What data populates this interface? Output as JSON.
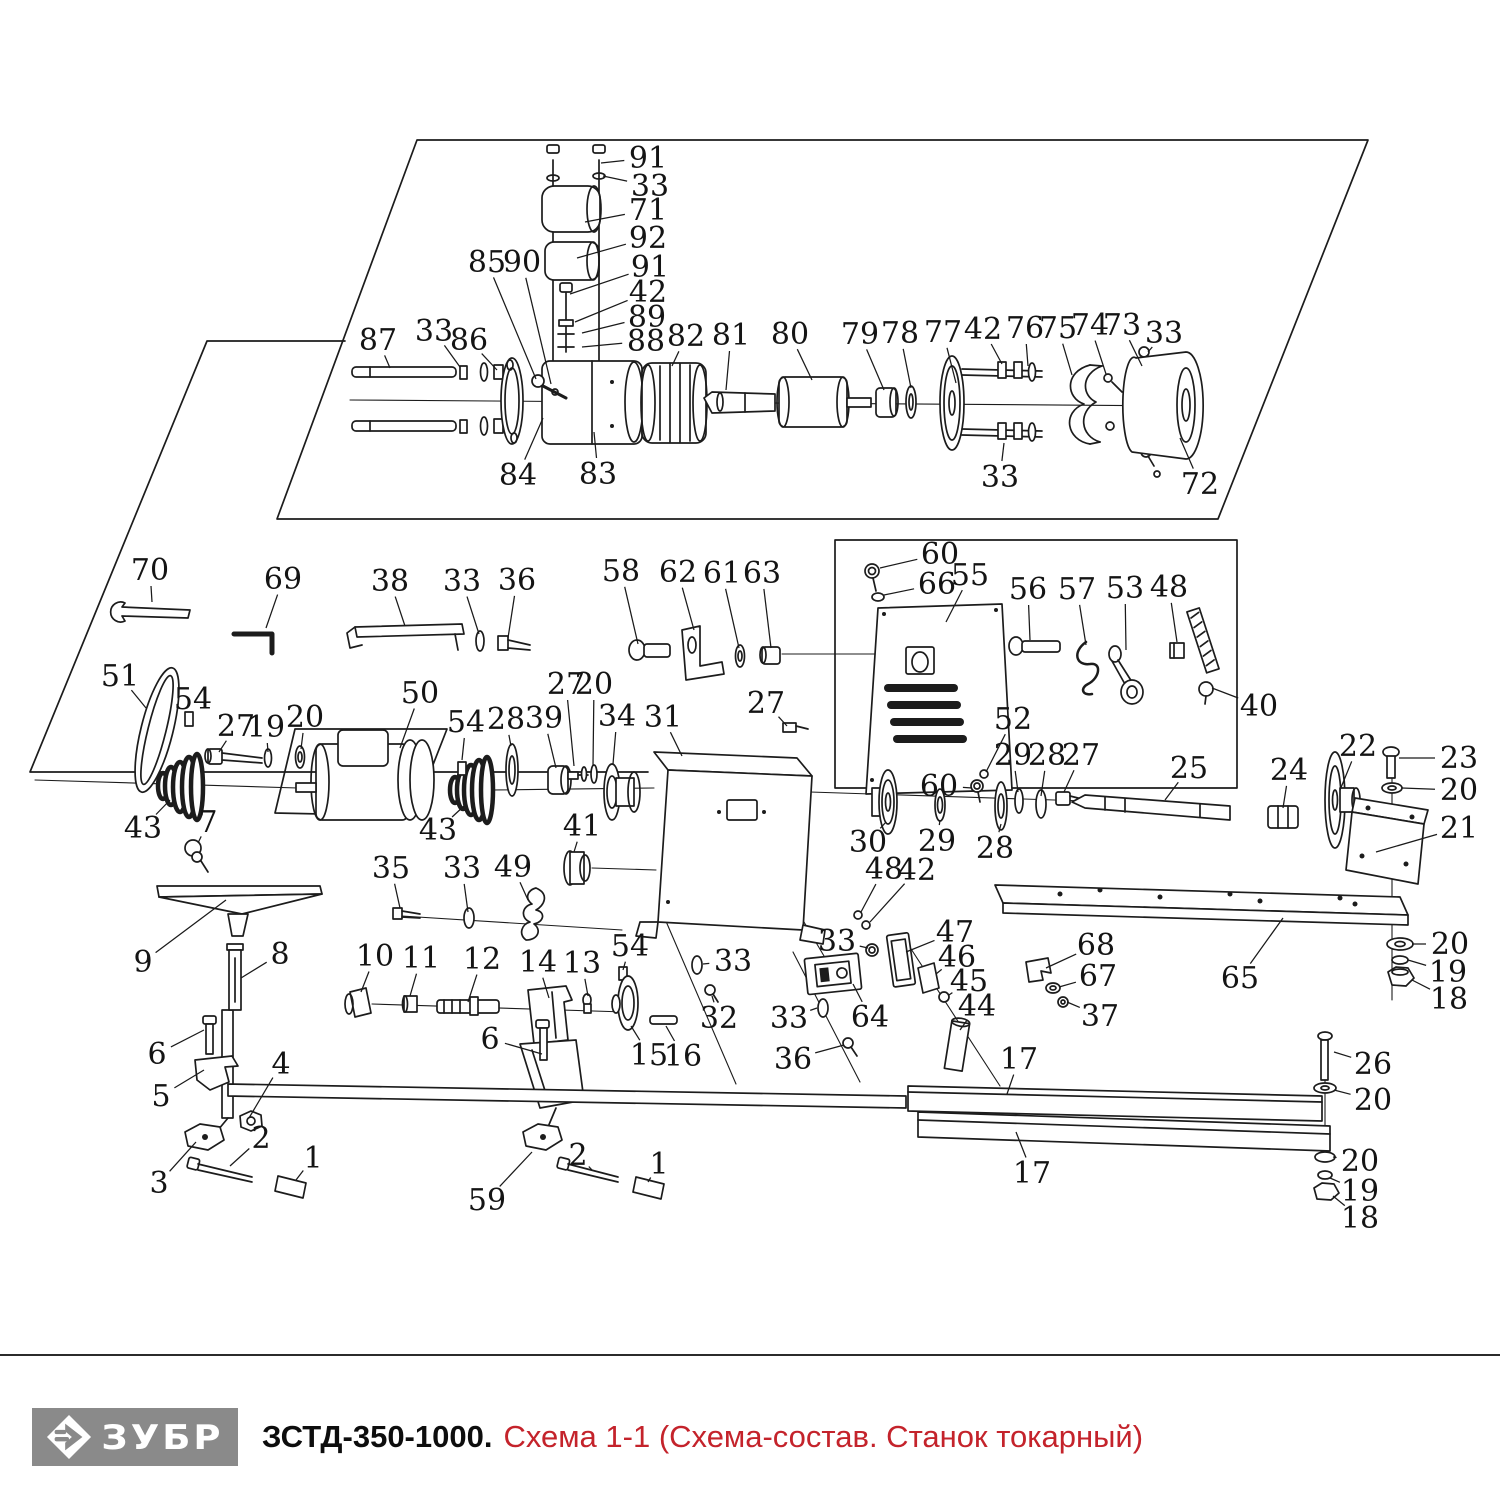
{
  "footer": {
    "brand": "ЗУБР",
    "model": "ЗСТД-350-1000.",
    "subtitle": "Схема 1-1 (Схема-состав. Станок токарный)",
    "logo_bg": "#8a8a8a",
    "accent": "#c4232b",
    "line_color": "#1c1c1c"
  },
  "diagram": {
    "labels": [
      {
        "n": "91",
        "x": 648,
        "y": 158,
        "tx": 601,
        "ty": 163
      },
      {
        "n": "33",
        "x": 650,
        "y": 186,
        "tx": 603,
        "ty": 176
      },
      {
        "n": "71",
        "x": 648,
        "y": 210,
        "tx": 585,
        "ty": 222
      },
      {
        "n": "92",
        "x": 648,
        "y": 238,
        "tx": 577,
        "ty": 258
      },
      {
        "n": "91",
        "x": 650,
        "y": 267,
        "tx": 570,
        "ty": 294
      },
      {
        "n": "42",
        "x": 648,
        "y": 292,
        "tx": 575,
        "ty": 322
      },
      {
        "n": "89",
        "x": 647,
        "y": 317,
        "tx": 582,
        "ty": 333
      },
      {
        "n": "88",
        "x": 646,
        "y": 341,
        "tx": 582,
        "ty": 347
      },
      {
        "n": "85",
        "x": 487,
        "y": 262,
        "tx": 536,
        "ty": 379
      },
      {
        "n": "90",
        "x": 522,
        "y": 262,
        "tx": 551,
        "ty": 384
      },
      {
        "n": "87",
        "x": 378,
        "y": 340,
        "tx": 390,
        "ty": 368
      },
      {
        "n": "33",
        "x": 434,
        "y": 331,
        "tx": 460,
        "ty": 367
      },
      {
        "n": "86",
        "x": 469,
        "y": 340,
        "tx": 497,
        "ty": 370
      },
      {
        "n": "84",
        "x": 518,
        "y": 475,
        "tx": 543,
        "ty": 418
      },
      {
        "n": "83",
        "x": 598,
        "y": 474,
        "tx": 594,
        "ty": 432
      },
      {
        "n": "82",
        "x": 686,
        "y": 336,
        "tx": 672,
        "ty": 366
      },
      {
        "n": "81",
        "x": 731,
        "y": 335,
        "tx": 726,
        "ty": 390
      },
      {
        "n": "80",
        "x": 790,
        "y": 334,
        "tx": 812,
        "ty": 380
      },
      {
        "n": "79",
        "x": 860,
        "y": 334,
        "tx": 884,
        "ty": 390
      },
      {
        "n": "78",
        "x": 900,
        "y": 333,
        "tx": 911,
        "ty": 388
      },
      {
        "n": "77",
        "x": 943,
        "y": 332,
        "tx": 956,
        "ty": 383
      },
      {
        "n": "42",
        "x": 983,
        "y": 329,
        "tx": 1002,
        "ty": 364
      },
      {
        "n": "76",
        "x": 1025,
        "y": 328,
        "tx": 1028,
        "ty": 366
      },
      {
        "n": "75",
        "x": 1058,
        "y": 328,
        "tx": 1072,
        "ty": 375
      },
      {
        "n": "74",
        "x": 1090,
        "y": 325,
        "tx": 1106,
        "ty": 374
      },
      {
        "n": "73",
        "x": 1122,
        "y": 325,
        "tx": 1142,
        "ty": 366
      },
      {
        "n": "33",
        "x": 1164,
        "y": 333,
        "tx": 1148,
        "ty": 352
      },
      {
        "n": "33",
        "x": 1000,
        "y": 477,
        "tx": 1004,
        "ty": 443
      },
      {
        "n": "72",
        "x": 1200,
        "y": 484,
        "tx": 1180,
        "ty": 438
      },
      {
        "n": "70",
        "x": 150,
        "y": 570,
        "tx": 152,
        "ty": 602
      },
      {
        "n": "69",
        "x": 283,
        "y": 579,
        "tx": 266,
        "ty": 628
      },
      {
        "n": "38",
        "x": 390,
        "y": 581,
        "tx": 405,
        "ty": 626
      },
      {
        "n": "33",
        "x": 462,
        "y": 581,
        "tx": 479,
        "ty": 634
      },
      {
        "n": "36",
        "x": 517,
        "y": 580,
        "tx": 508,
        "ty": 638
      },
      {
        "n": "58",
        "x": 621,
        "y": 571,
        "tx": 638,
        "ty": 644
      },
      {
        "n": "62",
        "x": 678,
        "y": 572,
        "tx": 694,
        "ty": 630
      },
      {
        "n": "61",
        "x": 722,
        "y": 573,
        "tx": 739,
        "ty": 648
      },
      {
        "n": "63",
        "x": 762,
        "y": 573,
        "tx": 771,
        "ty": 648
      },
      {
        "n": "60",
        "x": 940,
        "y": 554,
        "tx": 880,
        "ty": 568
      },
      {
        "n": "66",
        "x": 937,
        "y": 584,
        "tx": 884,
        "ty": 595
      },
      {
        "n": "55",
        "x": 970,
        "y": 575,
        "tx": 946,
        "ty": 622
      },
      {
        "n": "56",
        "x": 1028,
        "y": 589,
        "tx": 1030,
        "ty": 640
      },
      {
        "n": "57",
        "x": 1077,
        "y": 589,
        "tx": 1086,
        "ty": 645
      },
      {
        "n": "53",
        "x": 1125,
        "y": 588,
        "tx": 1126,
        "ty": 650
      },
      {
        "n": "48",
        "x": 1169,
        "y": 587,
        "tx": 1177,
        "ty": 642
      },
      {
        "n": "40",
        "x": 1259,
        "y": 706,
        "tx": 1212,
        "ty": 688
      },
      {
        "n": "51",
        "x": 120,
        "y": 676,
        "tx": 146,
        "ty": 708
      },
      {
        "n": "54",
        "x": 193,
        "y": 699,
        "tx": 189,
        "ty": 712
      },
      {
        "n": "27",
        "x": 236,
        "y": 726,
        "tx": 219,
        "ty": 752
      },
      {
        "n": "19",
        "x": 266,
        "y": 727,
        "tx": 268,
        "ty": 752
      },
      {
        "n": "20",
        "x": 305,
        "y": 717,
        "tx": 301,
        "ty": 749
      },
      {
        "n": "50",
        "x": 420,
        "y": 693,
        "tx": 400,
        "ty": 748
      },
      {
        "n": "43",
        "x": 143,
        "y": 828,
        "tx": 170,
        "ty": 800
      },
      {
        "n": "7",
        "x": 208,
        "y": 822,
        "tx": 198,
        "ty": 843
      },
      {
        "n": "9",
        "x": 143,
        "y": 962,
        "tx": 226,
        "ty": 900
      },
      {
        "n": "8",
        "x": 280,
        "y": 954,
        "tx": 241,
        "ty": 978
      },
      {
        "n": "27",
        "x": 566,
        "y": 684,
        "tx": 574,
        "ty": 766
      },
      {
        "n": "20",
        "x": 594,
        "y": 684,
        "tx": 593,
        "ty": 766
      },
      {
        "n": "54",
        "x": 466,
        "y": 722,
        "tx": 462,
        "ty": 760
      },
      {
        "n": "28",
        "x": 506,
        "y": 719,
        "tx": 511,
        "ty": 746
      },
      {
        "n": "39",
        "x": 544,
        "y": 718,
        "tx": 556,
        "ty": 768
      },
      {
        "n": "34",
        "x": 617,
        "y": 716,
        "tx": 613,
        "ty": 764
      },
      {
        "n": "31",
        "x": 663,
        "y": 717,
        "tx": 682,
        "ty": 756
      },
      {
        "n": "27",
        "x": 766,
        "y": 703,
        "tx": 787,
        "ty": 726
      },
      {
        "n": "41",
        "x": 582,
        "y": 826,
        "tx": 574,
        "ty": 852
      },
      {
        "n": "43",
        "x": 438,
        "y": 830,
        "tx": 464,
        "ty": 806
      },
      {
        "n": "35",
        "x": 391,
        "y": 868,
        "tx": 400,
        "ty": 908
      },
      {
        "n": "33",
        "x": 462,
        "y": 868,
        "tx": 468,
        "ty": 912
      },
      {
        "n": "49",
        "x": 513,
        "y": 867,
        "tx": 528,
        "ty": 900
      },
      {
        "n": "52",
        "x": 1013,
        "y": 719,
        "tx": 986,
        "ty": 772
      },
      {
        "n": "60",
        "x": 939,
        "y": 786,
        "tx": 972,
        "ty": 788
      },
      {
        "n": "29",
        "x": 1013,
        "y": 755,
        "tx": 1018,
        "ty": 792
      },
      {
        "n": "28",
        "x": 1047,
        "y": 755,
        "tx": 1041,
        "ty": 796
      },
      {
        "n": "27",
        "x": 1081,
        "y": 755,
        "tx": 1064,
        "ty": 792
      },
      {
        "n": "25",
        "x": 1189,
        "y": 768,
        "tx": 1165,
        "ty": 800
      },
      {
        "n": "24",
        "x": 1289,
        "y": 770,
        "tx": 1283,
        "ty": 808
      },
      {
        "n": "22",
        "x": 1358,
        "y": 746,
        "tx": 1340,
        "ty": 790
      },
      {
        "n": "23",
        "x": 1459,
        "y": 758,
        "tx": 1399,
        "ty": 758
      },
      {
        "n": "20",
        "x": 1459,
        "y": 790,
        "tx": 1402,
        "ty": 788
      },
      {
        "n": "21",
        "x": 1459,
        "y": 828,
        "tx": 1376,
        "ty": 852
      },
      {
        "n": "30",
        "x": 868,
        "y": 842,
        "tx": 886,
        "ty": 822
      },
      {
        "n": "29",
        "x": 937,
        "y": 841,
        "tx": 940,
        "ty": 820
      },
      {
        "n": "28",
        "x": 995,
        "y": 848,
        "tx": 1001,
        "ty": 824
      },
      {
        "n": "48",
        "x": 884,
        "y": 869,
        "tx": 861,
        "ty": 912
      },
      {
        "n": "42",
        "x": 917,
        "y": 870,
        "tx": 870,
        "ty": 922
      },
      {
        "n": "65",
        "x": 1240,
        "y": 978,
        "tx": 1283,
        "ty": 918
      },
      {
        "n": "20",
        "x": 1450,
        "y": 944,
        "tx": 1412,
        "ty": 944
      },
      {
        "n": "19",
        "x": 1448,
        "y": 972,
        "tx": 1408,
        "ty": 960
      },
      {
        "n": "18",
        "x": 1449,
        "y": 999,
        "tx": 1412,
        "ty": 980
      },
      {
        "n": "68",
        "x": 1096,
        "y": 945,
        "tx": 1046,
        "ty": 968
      },
      {
        "n": "67",
        "x": 1098,
        "y": 976,
        "tx": 1059,
        "ty": 987
      },
      {
        "n": "37",
        "x": 1100,
        "y": 1016,
        "tx": 1067,
        "ty": 1002
      },
      {
        "n": "47",
        "x": 955,
        "y": 932,
        "tx": 906,
        "ty": 952
      },
      {
        "n": "46",
        "x": 957,
        "y": 957,
        "tx": 936,
        "ty": 974
      },
      {
        "n": "45",
        "x": 969,
        "y": 981,
        "tx": 949,
        "ty": 995
      },
      {
        "n": "44",
        "x": 977,
        "y": 1006,
        "tx": 960,
        "ty": 1030
      },
      {
        "n": "33",
        "x": 837,
        "y": 941,
        "tx": 868,
        "ty": 948
      },
      {
        "n": "64",
        "x": 870,
        "y": 1017,
        "tx": 853,
        "ty": 984
      },
      {
        "n": "33",
        "x": 733,
        "y": 961,
        "tx": 703,
        "ty": 964
      },
      {
        "n": "32",
        "x": 719,
        "y": 1018,
        "tx": 712,
        "ty": 996
      },
      {
        "n": "33",
        "x": 789,
        "y": 1018,
        "tx": 817,
        "ty": 1008
      },
      {
        "n": "36",
        "x": 793,
        "y": 1059,
        "tx": 844,
        "ty": 1045
      },
      {
        "n": "13",
        "x": 582,
        "y": 963,
        "tx": 588,
        "ty": 996
      },
      {
        "n": "54",
        "x": 630,
        "y": 946,
        "tx": 623,
        "ty": 970
      },
      {
        "n": "10",
        "x": 375,
        "y": 956,
        "tx": 361,
        "ty": 992
      },
      {
        "n": "11",
        "x": 421,
        "y": 958,
        "tx": 410,
        "ty": 996
      },
      {
        "n": "12",
        "x": 482,
        "y": 959,
        "tx": 468,
        "ty": 1002
      },
      {
        "n": "14",
        "x": 538,
        "y": 962,
        "tx": 549,
        "ty": 998
      },
      {
        "n": "15",
        "x": 649,
        "y": 1055,
        "tx": 631,
        "ty": 1026
      },
      {
        "n": "16",
        "x": 683,
        "y": 1056,
        "tx": 666,
        "ty": 1026
      },
      {
        "n": "17",
        "x": 1019,
        "y": 1059,
        "tx": 1007,
        "ty": 1094
      },
      {
        "n": "17",
        "x": 1032,
        "y": 1173,
        "tx": 1016,
        "ty": 1132
      },
      {
        "n": "26",
        "x": 1373,
        "y": 1064,
        "tx": 1334,
        "ty": 1052
      },
      {
        "n": "20",
        "x": 1373,
        "y": 1100,
        "tx": 1334,
        "ty": 1090
      },
      {
        "n": "20",
        "x": 1360,
        "y": 1161,
        "tx": 1333,
        "ty": 1157
      },
      {
        "n": "19",
        "x": 1360,
        "y": 1191,
        "tx": 1330,
        "ty": 1178
      },
      {
        "n": "18",
        "x": 1360,
        "y": 1218,
        "tx": 1333,
        "ty": 1196
      },
      {
        "n": "6",
        "x": 157,
        "y": 1054,
        "tx": 204,
        "ty": 1030
      },
      {
        "n": "5",
        "x": 161,
        "y": 1096,
        "tx": 204,
        "ty": 1070
      },
      {
        "n": "4",
        "x": 281,
        "y": 1064,
        "tx": 249,
        "ty": 1118
      },
      {
        "n": "3",
        "x": 159,
        "y": 1183,
        "tx": 196,
        "ty": 1142
      },
      {
        "n": "2",
        "x": 261,
        "y": 1138,
        "tx": 230,
        "ty": 1166
      },
      {
        "n": "1",
        "x": 313,
        "y": 1158,
        "tx": 296,
        "ty": 1180
      },
      {
        "n": "6",
        "x": 490,
        "y": 1039,
        "tx": 542,
        "ty": 1054
      },
      {
        "n": "59",
        "x": 487,
        "y": 1200,
        "tx": 532,
        "ty": 1152
      },
      {
        "n": "2",
        "x": 578,
        "y": 1155,
        "tx": 592,
        "ty": 1170
      },
      {
        "n": "1",
        "x": 659,
        "y": 1164,
        "tx": 648,
        "ty": 1182
      }
    ]
  }
}
